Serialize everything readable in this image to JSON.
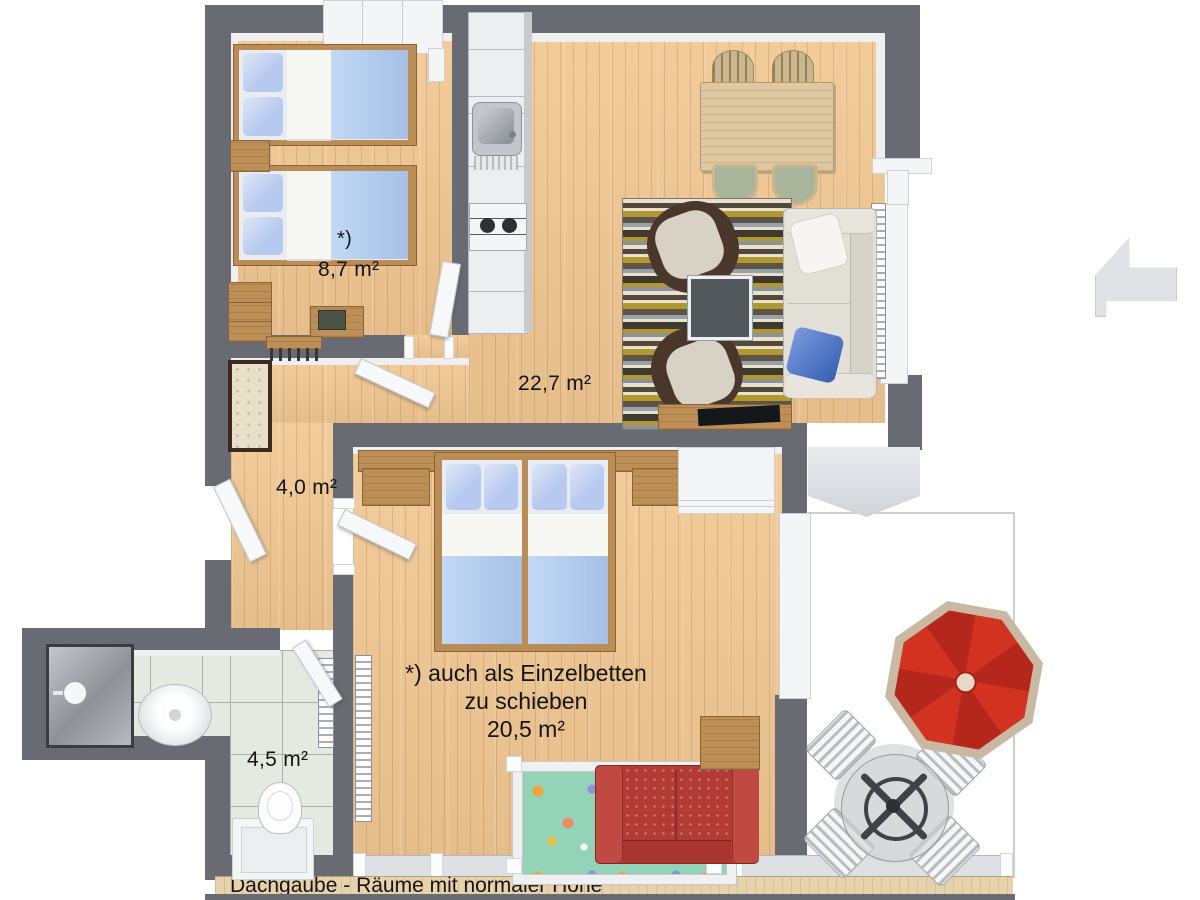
{
  "plan": {
    "caption": "Dachgaube - Räume mit normaler Höhe",
    "rooms": {
      "kids_bedroom": {
        "footnote_mark": "*)",
        "area": "8,7 m²"
      },
      "living_room": {
        "area": "22,7 m²"
      },
      "hallway": {
        "area": "4,0 m²"
      },
      "bathroom": {
        "area": "4,5 m²"
      },
      "master_bedroom": {
        "area": "20,5 m²",
        "note_line1": "*) auch als Einzelbetten",
        "note_line2": "zu schieben"
      }
    },
    "colors": {
      "wall": "#686c72",
      "floor_wood": "#f1c893",
      "bathroom_tile": "#e4e9e1",
      "bed_blue": "#aecbf2",
      "sofa_beige": "#e2dfd7",
      "sofa_red": "#b23b35",
      "umbrella_red": "#cd2d1e",
      "rug_olive": "#b2992f",
      "rug_brown": "#53493a"
    }
  }
}
